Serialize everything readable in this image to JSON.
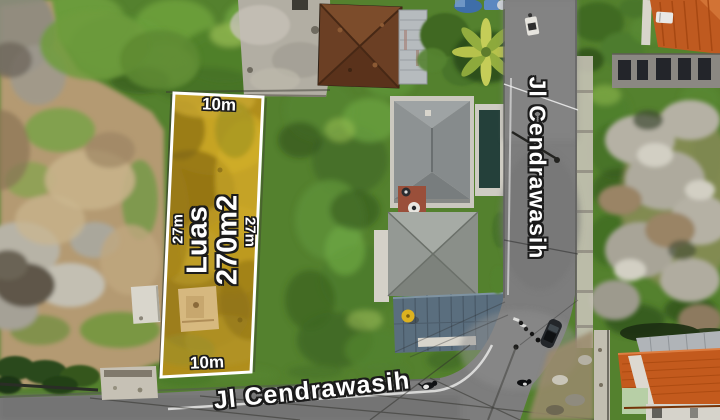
{
  "overlay": {
    "plot": {
      "area_line1": "Luas",
      "area_line2": "270m2",
      "top_width": "10m",
      "bottom_width": "10m",
      "left_depth": "27m",
      "right_depth": "27m"
    },
    "streets": {
      "vertical": "Jl Cendrawasih",
      "horizontal": "Jl Cendrawasih"
    },
    "watermark": "rumah123"
  },
  "colors": {
    "plot_fill": "#b08e1c",
    "plot_border": "#ffffff",
    "label_text": "#ffffff",
    "label_outline": "#1b1b1b",
    "watermark": "rgba(255,255,255,0.17)"
  }
}
